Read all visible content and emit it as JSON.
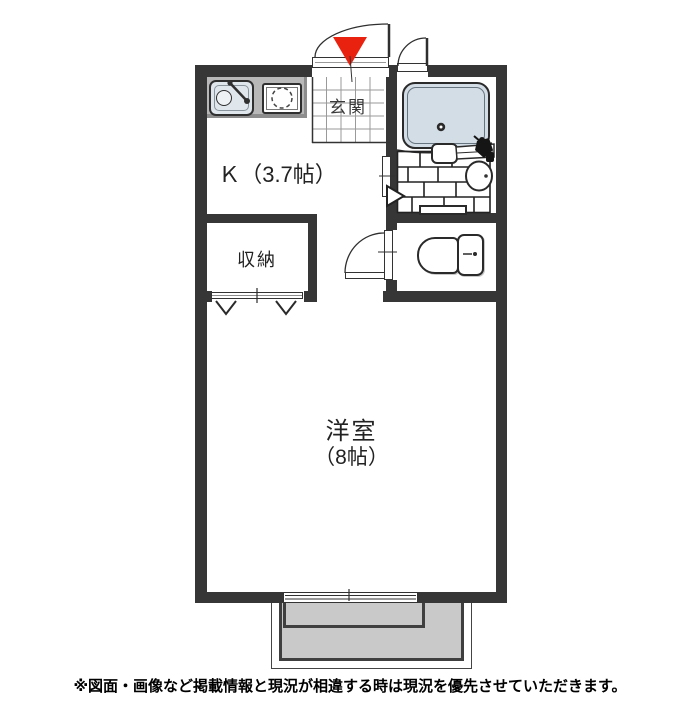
{
  "floorplan": {
    "labels": {
      "kitchen": "Ｋ（3.7帖）",
      "entrance": "玄関",
      "closet": "収納",
      "western_room": "洋室",
      "western_room_size": "（8帖）"
    },
    "icons": [
      "entrance-marker-icon",
      "entrance-door-swing-icon",
      "second-door-swing-icon",
      "sink-icon",
      "stove-burner-icon",
      "bathtub-icon",
      "bathtub-drain-icon",
      "washbasin-icon",
      "bath-faucet-icon",
      "bath-door-arrow-icon",
      "toilet-icon",
      "toilet-door-swing-icon",
      "closet-folding-door-icon",
      "sliding-window-icon"
    ],
    "colors": {
      "wall": "#363636",
      "marker_red": "#e8220f",
      "bathtub_fill": "#d3dde6",
      "balcony_fill": "#c9c9c9",
      "counter_fill": "#b8b8b8",
      "sink_fill": "#dfe6ec"
    }
  },
  "footer": {
    "disclaimer": "※図面・画像など掲載情報と現況が相違する時は現況を優先させていただきます。"
  }
}
